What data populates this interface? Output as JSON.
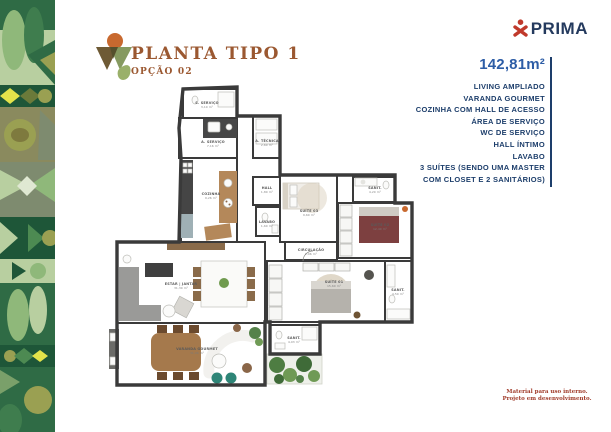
{
  "header": {
    "title": "PLANTA TIPO 1",
    "subtitle": "OPÇÃO 02"
  },
  "brand": {
    "name": "PRIMA"
  },
  "specs": {
    "area": "142,81m²",
    "features": [
      "LIVING AMPLIADO",
      "VARANDA GOURMET",
      "COZINHA COM HALL DE ACESSO",
      "ÁREA DE SERVIÇO",
      "WC DE SERVIÇO",
      "HALL ÍNTIMO",
      "LAVABO",
      "3 SUÍTES (SENDO UMA MASTER",
      "COM CLOSET E 2 SANITÁRIOS)"
    ]
  },
  "footer": {
    "line1": "Material para uso interno.",
    "line2": "Projeto em desenvolvimento."
  },
  "colors": {
    "title_brown": "#9b5831",
    "navy": "#1d3e6b",
    "area_blue": "#2d5da6",
    "brand_red": "#c0392b",
    "wall": "#3a3a3a"
  },
  "floorplan": {
    "rooms": [
      {
        "name": "S. SERVIÇO",
        "area": "3,10 m²",
        "x": 100,
        "y": 19
      },
      {
        "name": "A. SERVIÇO",
        "area": "7,16 m²",
        "x": 106,
        "y": 58
      },
      {
        "name": "A. TÉCNICA",
        "area": "2,60 m²",
        "x": 160,
        "y": 57
      },
      {
        "name": "COZINHA",
        "area": "9,26 m²",
        "x": 104,
        "y": 110
      },
      {
        "name": "HALL",
        "area": "1,80 m²",
        "x": 160,
        "y": 104
      },
      {
        "name": "LAVABO",
        "area": "1,60 m²",
        "x": 160,
        "y": 138
      },
      {
        "name": "SUÍTE 03",
        "area": "9,60 m²",
        "x": 202,
        "y": 127
      },
      {
        "name": "SANIT.",
        "area": "4,20 m²",
        "x": 268,
        "y": 104
      },
      {
        "name": "SUÍTE 02",
        "area": "12,40 m²",
        "x": 273,
        "y": 141
      },
      {
        "name": "CIRCULAÇÃO",
        "area": "2,06 m²",
        "x": 204,
        "y": 166
      },
      {
        "name": "ESTAR | JANTAR",
        "area": "31,30 m²",
        "x": 74,
        "y": 200
      },
      {
        "name": "SUÍTE 01",
        "area": "15,60 m²",
        "x": 227,
        "y": 198
      },
      {
        "name": "SANIT.",
        "area": "4,50 m²",
        "x": 291,
        "y": 206
      },
      {
        "name": "SANIT.",
        "area": "4,03 m²",
        "x": 187,
        "y": 254
      },
      {
        "name": "VARANDA GOURMET",
        "area": "31,06 m²",
        "x": 90,
        "y": 265
      }
    ]
  }
}
